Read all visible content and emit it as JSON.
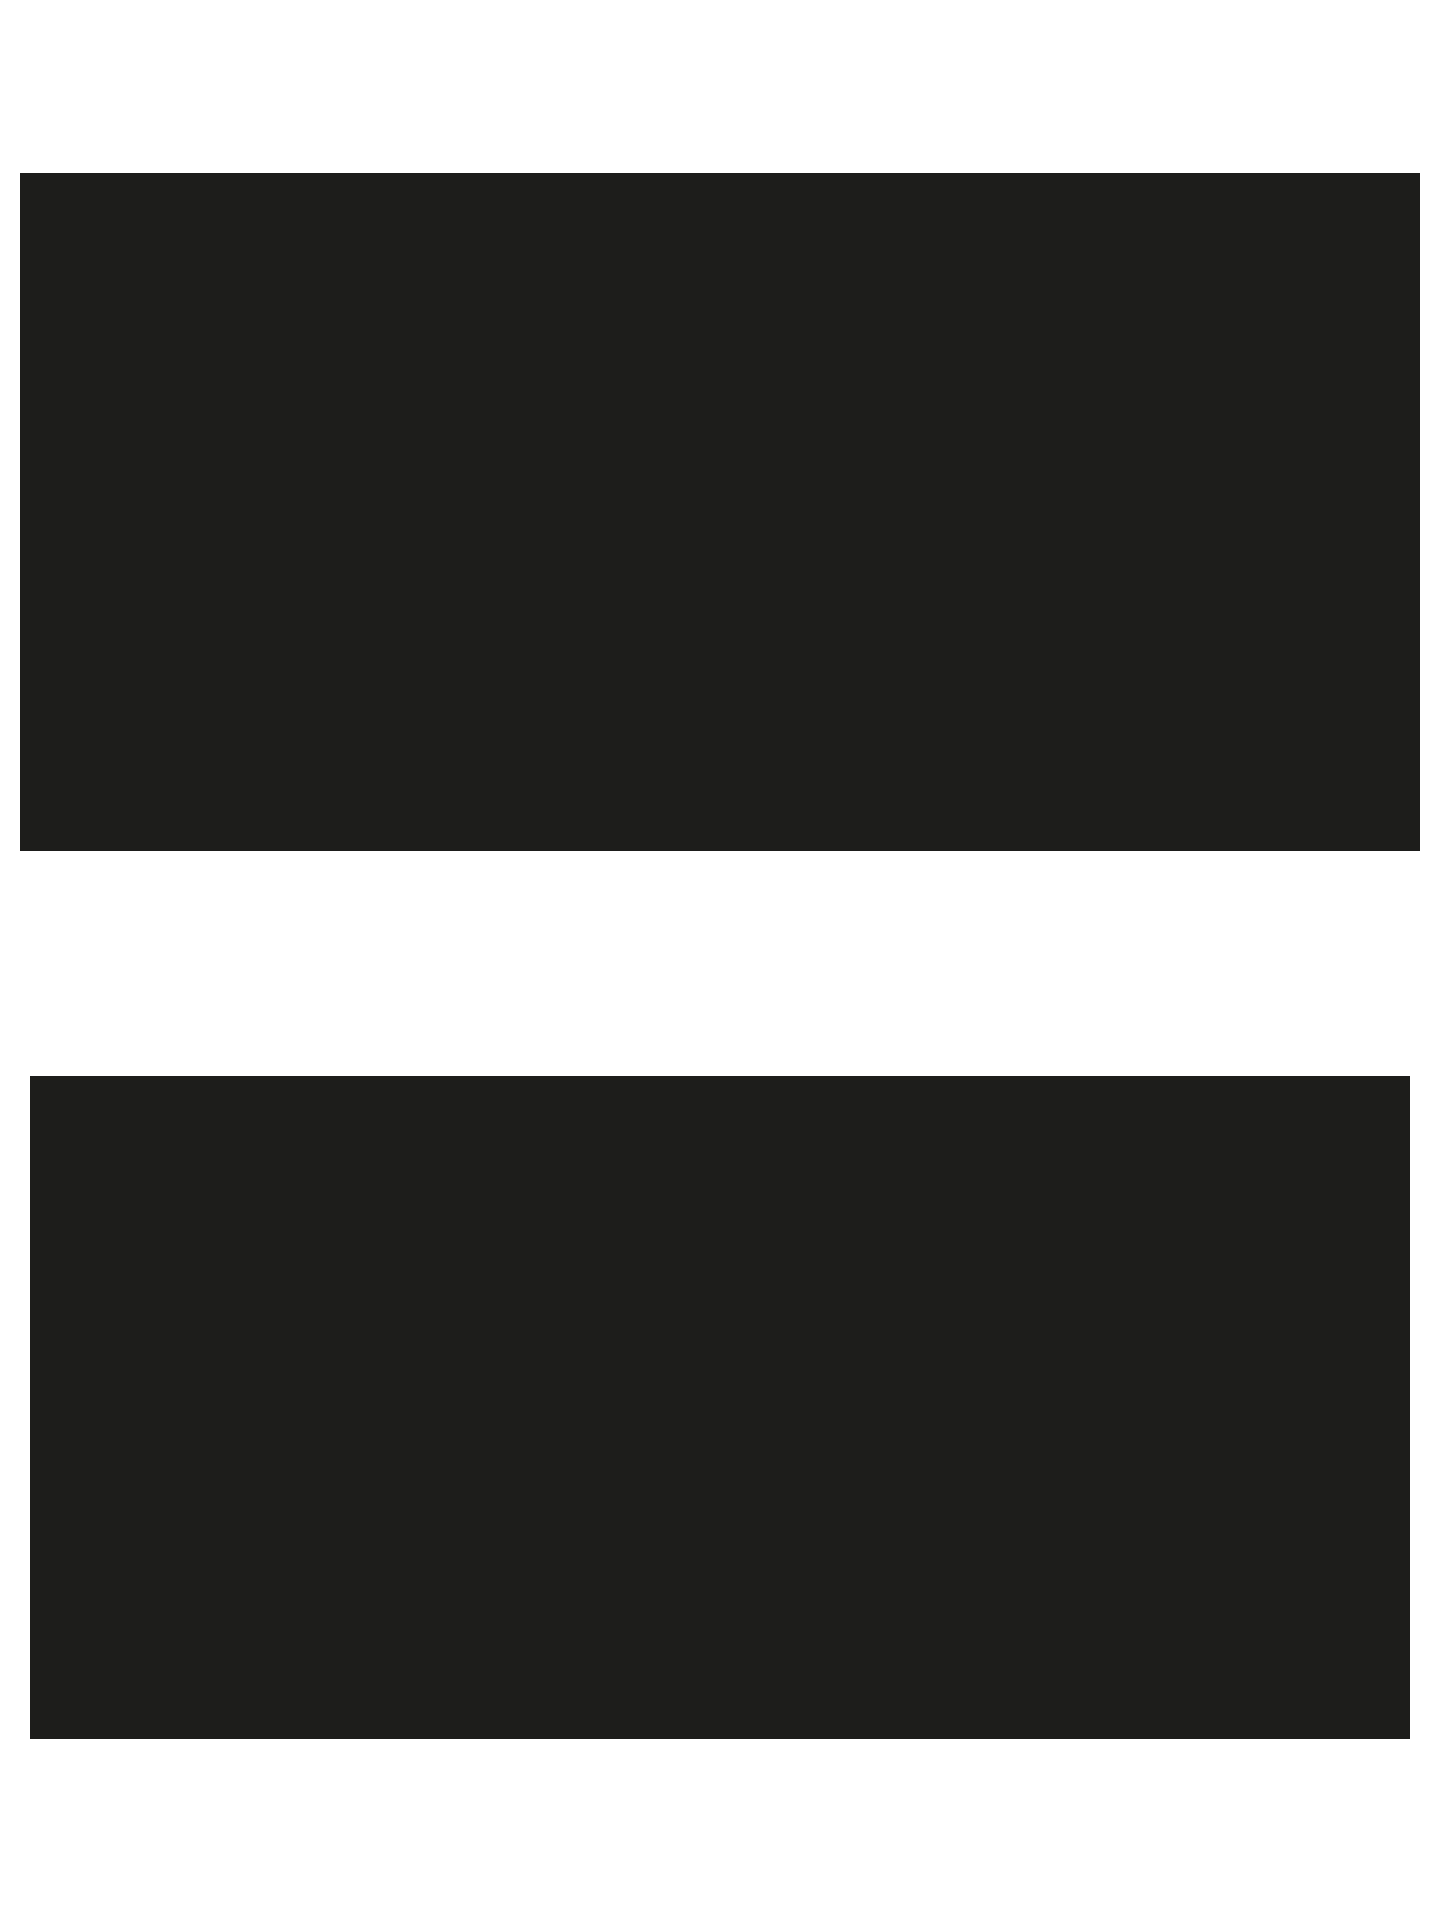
{
  "page": {
    "background_color": "#ffffff"
  },
  "panels": {
    "top": {
      "label": "",
      "color": "#1d1d1b"
    },
    "bottom": {
      "label": "",
      "color": "#1d1d1b"
    }
  }
}
